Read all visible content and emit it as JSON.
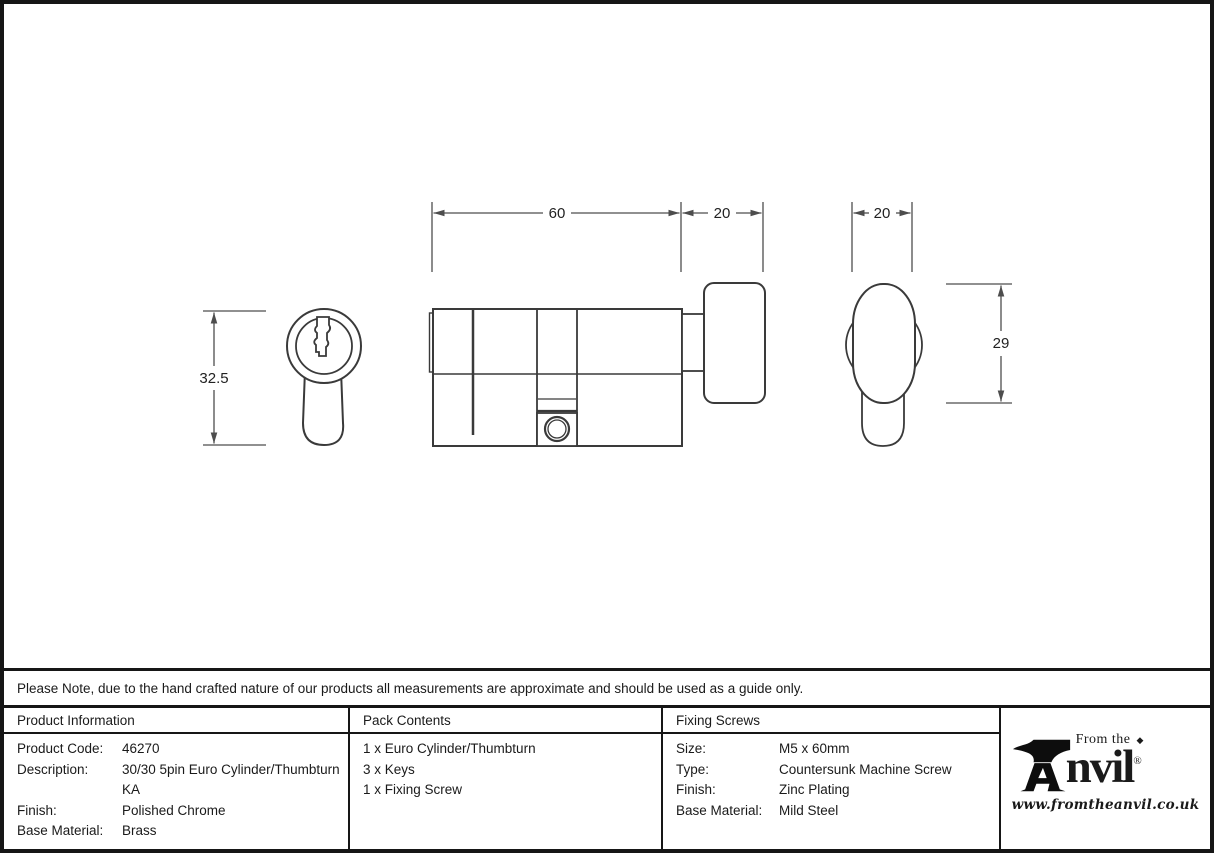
{
  "note": "Please Note, due to the hand crafted nature of our products all measurements are approximate and should be used as a guide only.",
  "drawing": {
    "dimensions": {
      "body_length": "60",
      "thumbturn_depth": "20",
      "thumbturn_width": "20",
      "cylinder_height": "32.5",
      "thumbturn_height": "29"
    }
  },
  "product_information": {
    "header": "Product Information",
    "rows": [
      {
        "label": "Product Code:",
        "value": "46270"
      },
      {
        "label": "Description:",
        "value": "30/30 5pin Euro Cylinder/Thumbturn KA"
      },
      {
        "label": "Finish:",
        "value": "Polished Chrome"
      },
      {
        "label": "Base Material:",
        "value": "Brass"
      }
    ]
  },
  "pack_contents": {
    "header": "Pack Contents",
    "items": [
      "1 x Euro Cylinder/Thumbturn",
      "3 x Keys",
      "1 x Fixing Screw"
    ]
  },
  "fixing_screws": {
    "header": "Fixing Screws",
    "rows": [
      {
        "label": "Size:",
        "value": "M5 x 60mm"
      },
      {
        "label": "Type:",
        "value": "Countersunk Machine Screw"
      },
      {
        "label": "Finish:",
        "value": "Zinc Plating"
      },
      {
        "label": "Base Material:",
        "value": "Mild Steel"
      }
    ]
  },
  "logo": {
    "from_the": "From the",
    "diamond": "◆",
    "name_rest": "nvil",
    "registered": "®",
    "url": "www.fromtheanvil.co.uk"
  },
  "colors": {
    "outline": "#3a3a3a",
    "dimension_line": "#4d4d4d",
    "border": "#161616",
    "text": "#1a1a1a"
  }
}
